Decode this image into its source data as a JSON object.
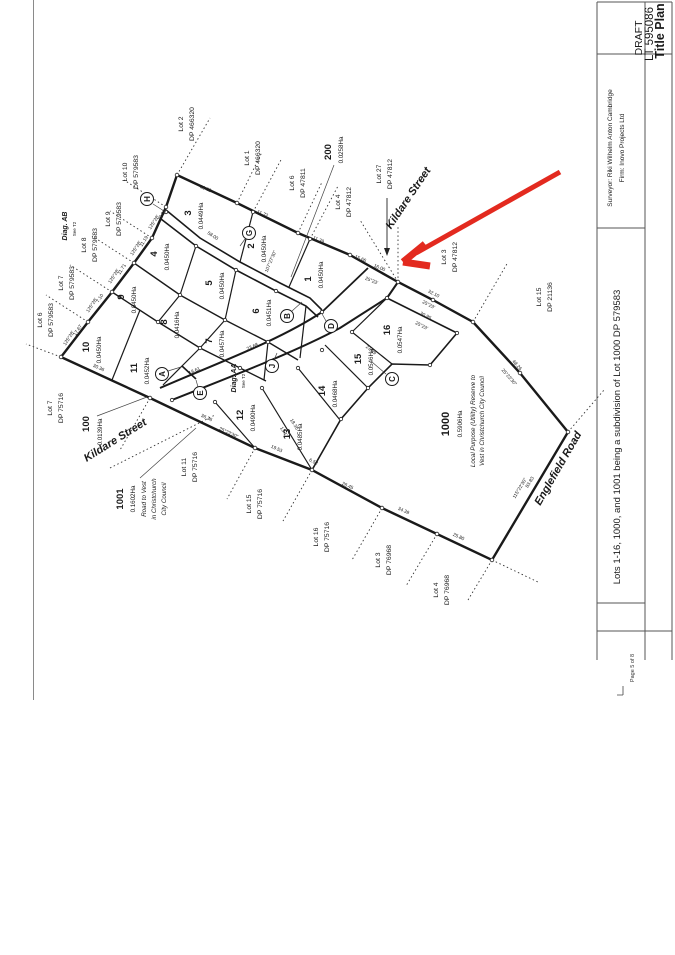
{
  "title_block": {
    "title": "Title Plan",
    "lt": "LT 595086",
    "status": "DRAFT",
    "surveyor": "Surveyor: Riki Wilhelm Anton Cambridge",
    "firm": "Firm: Inovo Projects Ltd",
    "description": "Lots 1-16, 1000, and 1001 being a subdivision of Lot 1000 DP 579583",
    "page": "Page 5 of 8"
  },
  "streets": {
    "kildare_ne": "Kildare Street",
    "kildare_sw": "Kildare Street",
    "englefield": "Englefield Road"
  },
  "diagrams": {
    "aa": "Diag. AA",
    "aa_ref": "See T2",
    "ab": "Diag. AB",
    "ab_ref": "See T2"
  },
  "lots": [
    {
      "n": "3",
      "a": "0.0449Ha"
    },
    {
      "n": "2",
      "a": "0.0450Ha"
    },
    {
      "n": "1",
      "a": "0.0450Ha"
    },
    {
      "n": "4",
      "a": "0.0450Ha"
    },
    {
      "n": "5",
      "a": "0.0450Ha"
    },
    {
      "n": "6",
      "a": "0.0451Ha"
    },
    {
      "n": "9",
      "a": "0.0450Ha"
    },
    {
      "n": "8",
      "a": "0.0416Ha"
    },
    {
      "n": "7",
      "a": "0.0457Ha"
    },
    {
      "n": "10",
      "a": "0.0450Ha"
    },
    {
      "n": "11",
      "a": "0.0452Ha"
    },
    {
      "n": "12",
      "a": "0.0490Ha"
    },
    {
      "n": "13",
      "a": "0.0485Ha"
    },
    {
      "n": "14",
      "a": "0.0468Ha"
    },
    {
      "n": "15",
      "a": "0.0546Ha"
    },
    {
      "n": "16",
      "a": "0.0547Ha"
    }
  ],
  "parcels": {
    "p100": {
      "n": "100",
      "a": "0.0139Ha"
    },
    "p200": {
      "n": "200",
      "a": "0.0258Ha"
    },
    "p1000": {
      "n": "1000",
      "a": "0.5906Ha",
      "d1": "Local Purpose (Utility) Reserve to",
      "d2": "Vest in Christchurch City Council"
    },
    "p1001": {
      "n": "1001",
      "a": "0.1602Ha",
      "d1": "Road to Vest",
      "d2": "in Christchurch",
      "d3": "City Council"
    }
  },
  "adjoining": [
    {
      "lot": "Lot 2",
      "dp": "DP 466320"
    },
    {
      "lot": "Lot 1",
      "dp": "DP 466320"
    },
    {
      "lot": "Lot 6",
      "dp": "DP 47811"
    },
    {
      "lot": "Lot 4",
      "dp": "DP 47812"
    },
    {
      "lot": "Lot 27",
      "dp": "DP 47812"
    },
    {
      "lot": "Lot 3",
      "dp": "DP 47812"
    },
    {
      "lot": "Lot 15",
      "dp": "DP 21136"
    },
    {
      "lot": "Lot 10",
      "dp": "DP 579583"
    },
    {
      "lot": "Lot 9",
      "dp": "DP 579583"
    },
    {
      "lot": "Lot 8",
      "dp": "DP 579583"
    },
    {
      "lot": "Lot 7",
      "dp": "DP 579583"
    },
    {
      "lot": "Lot 6",
      "dp": "DP 579583"
    },
    {
      "lot": "Lot 7",
      "dp": "DP 75716"
    },
    {
      "lot": "Lot 11",
      "dp": "DP 75716"
    },
    {
      "lot": "Lot 15",
      "dp": "DP 75716"
    },
    {
      "lot": "Lot 16",
      "dp": "DP 75716"
    },
    {
      "lot": "Lot 3",
      "dp": "DP 76968"
    },
    {
      "lot": "Lot 4",
      "dp": "DP 76968"
    }
  ],
  "letters": [
    "H",
    "G",
    "B",
    "D",
    "C",
    "J",
    "E",
    "A"
  ],
  "dims": [
    "13.62",
    "11.72",
    "11.39",
    "15.66",
    "16.00",
    "25°23'",
    "32.10",
    "25°23'",
    "48.26",
    "25°23'30\"",
    "115°22'30\"",
    "83.83",
    "25.80",
    "34.39",
    "26.45",
    "6.52",
    "19.53",
    "36.36",
    "25°23'30\"",
    "30.36",
    "125°28'",
    "17.67",
    "125°28'",
    "7.10",
    "125°28'",
    "11.71",
    "125°28'",
    "11.19",
    "125°28'",
    "10.81",
    "58.00",
    "30.95",
    "25°23'",
    "27.09",
    "18.35",
    "13.17",
    "18.61",
    "23.68",
    "107°27'30\""
  ],
  "colors": {
    "arrow_red": "#e32a1f",
    "ink": "#1a1a1a"
  }
}
